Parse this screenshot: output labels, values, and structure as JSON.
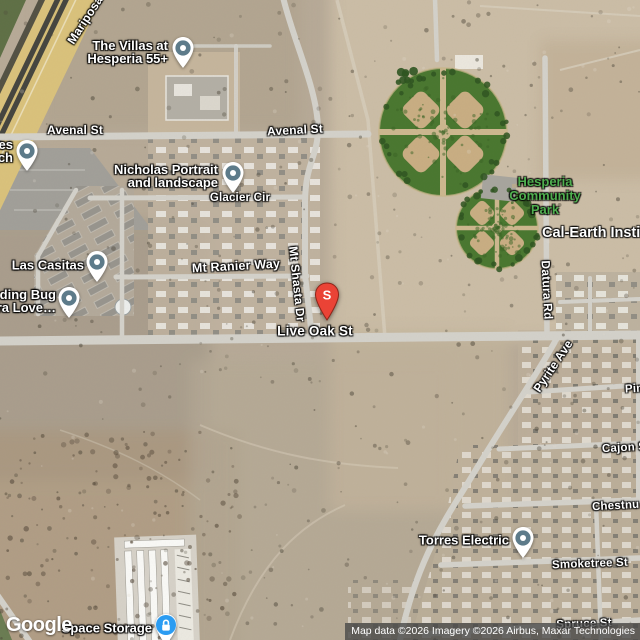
{
  "attribution": {
    "text": "Map data ©2026 Imagery ©2026 Airbus, Maxar Technologies"
  },
  "logo": {
    "text": "Google"
  },
  "search_marker": {
    "letter": "S",
    "x": 327,
    "y": 295
  },
  "colors": {
    "poi_pin": "#5d7b8a",
    "storage_pin": "#2b9cf2",
    "marker_red": "#ea4336",
    "park_label": "#4fae4f",
    "label_white": "#ffffff"
  },
  "road_labels": [
    {
      "text": "Mariposa",
      "x": 85,
      "y": 20,
      "rotate": -57,
      "size": 12
    },
    {
      "text": "Avenal St",
      "x": 75,
      "y": 130,
      "rotate": 0,
      "size": 12
    },
    {
      "text": "Avenal St",
      "x": 295,
      "y": 130,
      "rotate": -3,
      "size": 12
    },
    {
      "text": "Glacier Cir",
      "x": 240,
      "y": 198,
      "rotate": 0
    },
    {
      "text": "Mt Ranier Way",
      "x": 236,
      "y": 266,
      "rotate": -3,
      "size": 12.5
    },
    {
      "text": "Mt Shasta Dr",
      "x": 297,
      "y": 284,
      "rotate": 84,
      "size": 12
    },
    {
      "text": "Live Oak St",
      "x": 315,
      "y": 331,
      "rotate": 0,
      "size": 13.5
    },
    {
      "text": "Datura Rd",
      "x": 547,
      "y": 290,
      "rotate": 87,
      "size": 12
    },
    {
      "text": "Pyrite Ave",
      "x": 553,
      "y": 366,
      "rotate": -56,
      "size": 12
    },
    {
      "text": "Pin",
      "x": 625,
      "y": 389,
      "rotate": -3,
      "align": "left"
    },
    {
      "text": "Cajon S",
      "x": 602,
      "y": 448,
      "rotate": -3,
      "align": "left"
    },
    {
      "text": "Chestnu",
      "x": 592,
      "y": 506,
      "rotate": -3,
      "align": "left"
    },
    {
      "text": "Smoketree St",
      "x": 590,
      "y": 564,
      "rotate": -2
    },
    {
      "text": "Spruce St",
      "x": 584,
      "y": 624,
      "rotate": -2
    }
  ],
  "area_labels": [
    {
      "id": "hesperia-community-park",
      "lines": [
        "Hesperia",
        "Community",
        "Park"
      ],
      "x": 545,
      "y": 196,
      "align": "center",
      "color": "park_green",
      "size": 13
    },
    {
      "id": "cal-earth-institute",
      "lines": [
        "Cal-Earth Institu"
      ],
      "x": 542,
      "y": 234,
      "align": "left",
      "color": "white",
      "size": 14.5
    }
  ],
  "poi_labels": [
    {
      "id": "the-villas-at-hesperia-55",
      "lines": [
        "The Villas at",
        "Hesperia 55+"
      ],
      "pin_x": 183,
      "pin_y": 48,
      "label_right": 168,
      "label_cy": 52,
      "pin_type": "generic"
    },
    {
      "id": "church-edge",
      "lines": [
        "es",
        "ch"
      ],
      "pin_x": 27,
      "pin_y": 151,
      "label_right": 13,
      "label_cy": 151,
      "pin_type": "generic"
    },
    {
      "id": "nicholas-portrait-and-landscape",
      "lines": [
        "Nicholas Portrait",
        "and landscape"
      ],
      "pin_x": 233,
      "pin_y": 173,
      "label_right": 218,
      "label_cy": 176,
      "pin_type": "generic"
    },
    {
      "id": "las-casitas",
      "lines": [
        "Las Casitas"
      ],
      "pin_x": 97,
      "pin_y": 262,
      "label_right": 84,
      "label_cy": 265,
      "pin_type": "generic"
    },
    {
      "id": "bug-edge",
      "lines": [
        "ding Bug",
        "ra Love…"
      ],
      "pin_x": 69,
      "pin_y": 298,
      "label_right": 56,
      "label_cy": 301,
      "pin_type": "generic"
    },
    {
      "id": "torres-electric",
      "lines": [
        "Torres Electric"
      ],
      "pin_x": 523,
      "pin_y": 538,
      "label_right": 509,
      "label_cy": 540,
      "pin_type": "generic"
    },
    {
      "id": "space-storage",
      "lines": [
        "Space Storage"
      ],
      "pin_x": 166,
      "pin_y": 625,
      "label_right": 152,
      "label_cy": 628,
      "pin_type": "storage"
    }
  ]
}
